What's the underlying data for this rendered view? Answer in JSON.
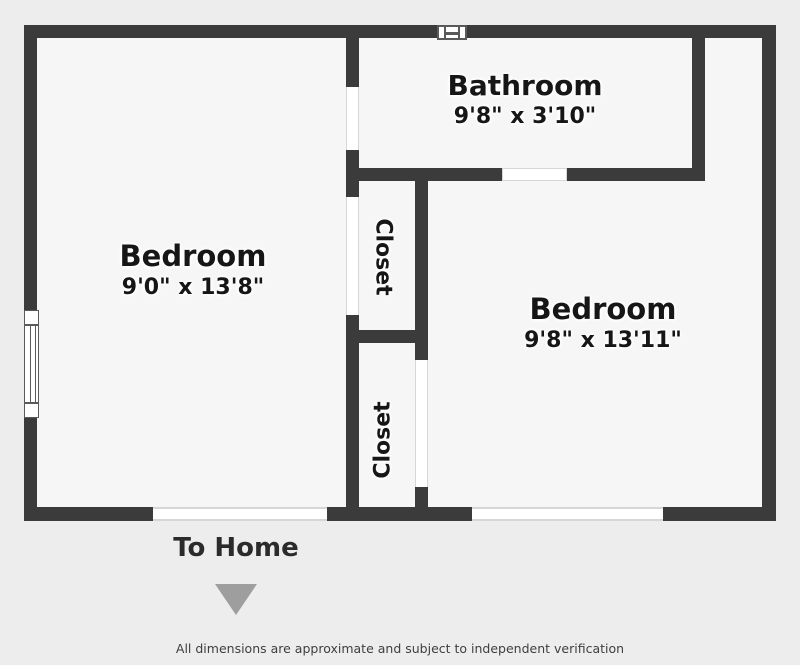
{
  "title": "Floor plan",
  "colors": {
    "wall": "#3b3b3b",
    "floor": "#f6f6f7",
    "background": "#ededee",
    "opening_edge": "#d6d6d6",
    "window_frame": "#5a5a5a",
    "arrow": "#9e9e9e",
    "label": "#161616",
    "footer_text": "#2b2b2b",
    "disclaimer": "#3f3f3f"
  },
  "rooms": {
    "bedroom_left": {
      "name": "Bedroom",
      "dims": "9'0\" x 13'8\""
    },
    "bathroom": {
      "name": "Bathroom",
      "dims": "9'8\" x 3'10\""
    },
    "bedroom_right": {
      "name": "Bedroom",
      "dims": "9'8\" x 13'11\""
    },
    "closet_top": {
      "name": "Closet"
    },
    "closet_bottom": {
      "name": "Closet"
    }
  },
  "annotations": {
    "to_home": "To Home",
    "disclaimer": "All dimensions are approximate and subject to independent verification"
  }
}
